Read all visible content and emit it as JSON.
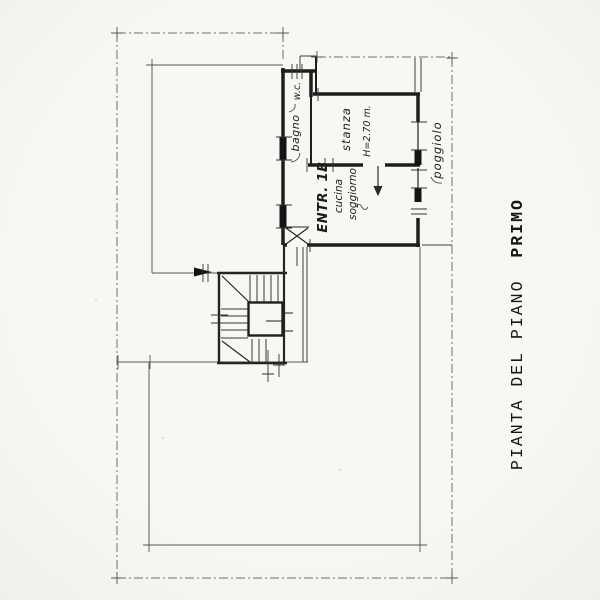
{
  "title": {
    "prefix": "PIANTA DEL PIANO",
    "emphasis": "PRIMO"
  },
  "rooms": {
    "wc": "w.c.",
    "bagno": "bagno",
    "stanza": "stanza",
    "stanza_height": "H=2.70 m.",
    "entrance_unit": "ENTR. 1B",
    "cucina": "cucina",
    "soggiorno": "soggiorno",
    "poggiolo": "poggiolo"
  },
  "colors": {
    "paper": "#f6f5f1",
    "ink_heavy": "#1e1e1e",
    "ink_medium": "#3a3a3a",
    "ink_light": "#6f6f6f"
  }
}
